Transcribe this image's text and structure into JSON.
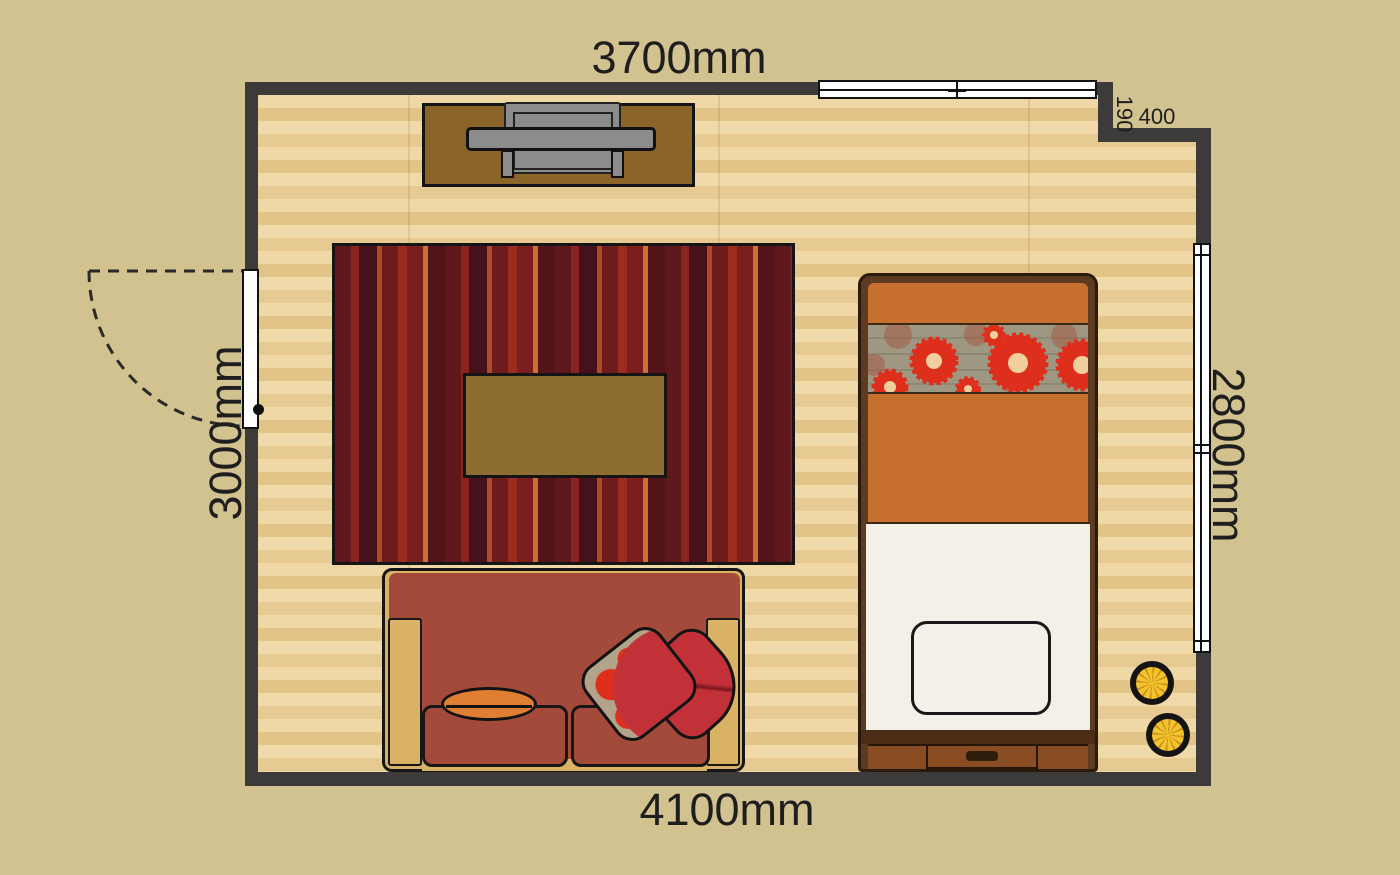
{
  "title": "Bedroom floor plan",
  "dimensions": {
    "top_wall": "3700mm",
    "bottom_wall": "4100mm",
    "left_wall": "3000mm",
    "right_wall": "2800mm",
    "notch_depth": "190",
    "notch_width": "400"
  },
  "colors": {
    "background": "#d2c28f",
    "wall": "#3c3b39",
    "floor_base": "#ead0a0",
    "rug_maroon": "#561419",
    "rug_orange_stripe": "#cf7033",
    "sofa_brick": "#a34a3a",
    "sofa_wood": "#d9b265",
    "bed_duvet": "#c8702f",
    "bed_floral_band": "#9e9882",
    "flower_red": "#dd2f1c",
    "bed_sheet": "#f3f0e8",
    "drawer_brown": "#8a4c22",
    "pouf_yellow": "#f2c52e",
    "tv_gray": "#8c8c8c",
    "cabinet_brown": "#8a6428",
    "table_brown": "#8e6d33"
  },
  "objects": [
    "door",
    "door-swing-arc",
    "window-top",
    "window-right",
    "tv-stand",
    "rug",
    "coffee-table",
    "sofa",
    "round-pillow",
    "floral-pillow",
    "red-pillow",
    "bed",
    "bed-pillow",
    "bed-drawer",
    "pouf",
    "pouf"
  ]
}
